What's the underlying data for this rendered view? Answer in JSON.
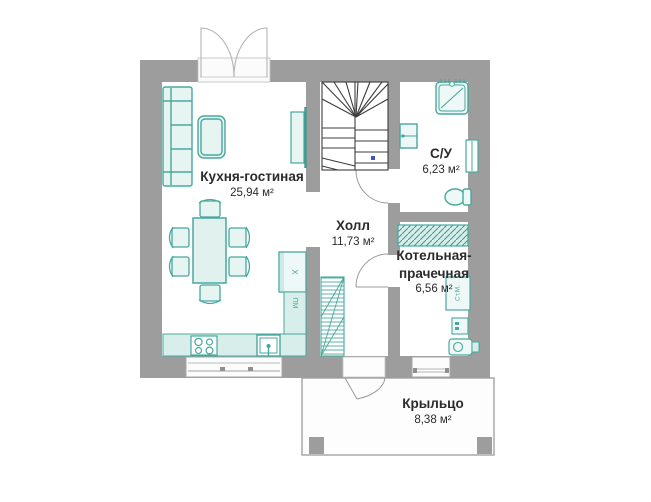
{
  "plan_title": "floor-plan",
  "rooms": [
    {
      "id": "kitchen_living",
      "name": "Кухня-гостиная",
      "area": "25,94 м²"
    },
    {
      "id": "hall",
      "name": "Холл",
      "area": "11,73 м²"
    },
    {
      "id": "bathroom",
      "name": "С/У",
      "area": "6,23 м²"
    },
    {
      "id": "boiler_laundry",
      "name": "Котельная-прачечная",
      "area": "6,56 м²"
    },
    {
      "id": "porch",
      "name": "Крыльцо",
      "area": "8,38 м²"
    }
  ],
  "appliance_labels": {
    "fridge": "Х",
    "dishwasher": "ПМ",
    "washing_machine": "Ст.М."
  },
  "colors": {
    "wall": "#9d9d9d",
    "furniture_stroke": "#48a89e",
    "furniture_fill": "#e6f4f2",
    "counter_fill": "#d8eeea",
    "stairs_stroke": "#3c3c3c",
    "text": "#2b2b2b",
    "accent_dot": "#3a57c4",
    "window_outline": "#a6a6a6"
  }
}
